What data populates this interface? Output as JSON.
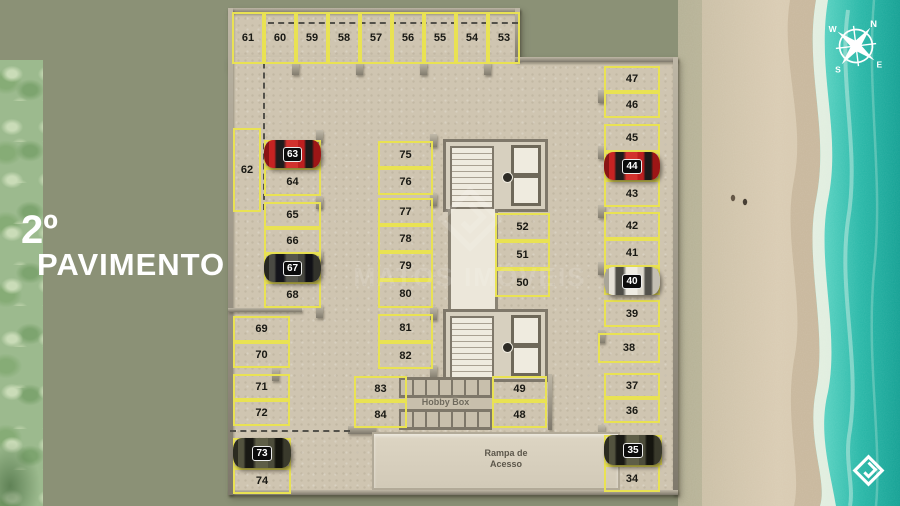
{
  "scene": {
    "title_line1": "2º",
    "title_line2": "PAVIMENTO",
    "watermark": "MATOS IMÓVEIS",
    "compass": {
      "n": "N",
      "e": "E",
      "s": "S",
      "w": "W"
    },
    "colors": {
      "background_sage": "#8b9176",
      "floor_concrete": "#cfc5b1",
      "stall_line_yellow": "#e9e253",
      "water_turquoise": "#1aab9c",
      "sand": "#d8cab1",
      "car_red": "#c62322",
      "car_dark": "#4a4a43",
      "car_white": "#e4e0d6",
      "car_olive": "#53533f"
    }
  },
  "floorplan": {
    "hobby_label": "Hobby Box",
    "ramp_label_line1": "Rampa de",
    "ramp_label_line2": "Acesso",
    "stalls": [
      {
        "n": "61",
        "x": 232,
        "y": 12,
        "w": 32,
        "h": 52,
        "car": null
      },
      {
        "n": "60",
        "x": 264,
        "y": 12,
        "w": 32,
        "h": 52,
        "car": null
      },
      {
        "n": "59",
        "x": 296,
        "y": 12,
        "w": 32,
        "h": 52,
        "car": null
      },
      {
        "n": "58",
        "x": 328,
        "y": 12,
        "w": 32,
        "h": 52,
        "car": null
      },
      {
        "n": "57",
        "x": 360,
        "y": 12,
        "w": 32,
        "h": 52,
        "car": null
      },
      {
        "n": "56",
        "x": 392,
        "y": 12,
        "w": 32,
        "h": 52,
        "car": null
      },
      {
        "n": "55",
        "x": 424,
        "y": 12,
        "w": 32,
        "h": 52,
        "car": null
      },
      {
        "n": "54",
        "x": 456,
        "y": 12,
        "w": 32,
        "h": 52,
        "car": null
      },
      {
        "n": "53",
        "x": 488,
        "y": 12,
        "w": 32,
        "h": 52,
        "car": null
      },
      {
        "n": "62",
        "x": 233,
        "y": 128,
        "w": 28,
        "h": 84,
        "car": null
      },
      {
        "n": "63",
        "x": 264,
        "y": 140,
        "w": 57,
        "h": 28,
        "car": "red"
      },
      {
        "n": "64",
        "x": 264,
        "y": 168,
        "w": 57,
        "h": 28,
        "car": null
      },
      {
        "n": "65",
        "x": 264,
        "y": 202,
        "w": 57,
        "h": 26,
        "car": null
      },
      {
        "n": "66",
        "x": 264,
        "y": 228,
        "w": 57,
        "h": 26,
        "car": null
      },
      {
        "n": "67",
        "x": 264,
        "y": 254,
        "w": 57,
        "h": 28,
        "car": "dark"
      },
      {
        "n": "68",
        "x": 264,
        "y": 282,
        "w": 57,
        "h": 26,
        "car": null
      },
      {
        "n": "69",
        "x": 233,
        "y": 316,
        "w": 57,
        "h": 26,
        "car": null
      },
      {
        "n": "70",
        "x": 233,
        "y": 342,
        "w": 57,
        "h": 26,
        "car": null
      },
      {
        "n": "71",
        "x": 233,
        "y": 374,
        "w": 57,
        "h": 26,
        "car": null
      },
      {
        "n": "72",
        "x": 233,
        "y": 400,
        "w": 57,
        "h": 26,
        "car": null
      },
      {
        "n": "73",
        "x": 233,
        "y": 438,
        "w": 58,
        "h": 30,
        "car": "olive"
      },
      {
        "n": "74",
        "x": 233,
        "y": 468,
        "w": 58,
        "h": 26,
        "car": null
      },
      {
        "n": "75",
        "x": 378,
        "y": 141,
        "w": 55,
        "h": 27,
        "car": null
      },
      {
        "n": "76",
        "x": 378,
        "y": 168,
        "w": 55,
        "h": 27,
        "car": null
      },
      {
        "n": "77",
        "x": 378,
        "y": 198,
        "w": 55,
        "h": 27,
        "car": null
      },
      {
        "n": "78",
        "x": 378,
        "y": 225,
        "w": 55,
        "h": 27,
        "car": null
      },
      {
        "n": "79",
        "x": 378,
        "y": 252,
        "w": 55,
        "h": 28,
        "car": null
      },
      {
        "n": "80",
        "x": 378,
        "y": 280,
        "w": 55,
        "h": 28,
        "car": null
      },
      {
        "n": "81",
        "x": 378,
        "y": 314,
        "w": 55,
        "h": 28,
        "car": null
      },
      {
        "n": "82",
        "x": 378,
        "y": 342,
        "w": 55,
        "h": 27,
        "car": null
      },
      {
        "n": "83",
        "x": 354,
        "y": 376,
        "w": 53,
        "h": 25,
        "car": null
      },
      {
        "n": "84",
        "x": 354,
        "y": 401,
        "w": 53,
        "h": 27,
        "car": null
      },
      {
        "n": "52",
        "x": 495,
        "y": 213,
        "w": 55,
        "h": 28,
        "car": null
      },
      {
        "n": "51",
        "x": 495,
        "y": 241,
        "w": 55,
        "h": 28,
        "car": null
      },
      {
        "n": "50",
        "x": 495,
        "y": 269,
        "w": 55,
        "h": 28,
        "car": null
      },
      {
        "n": "49",
        "x": 492,
        "y": 376,
        "w": 55,
        "h": 25,
        "car": null
      },
      {
        "n": "48",
        "x": 492,
        "y": 401,
        "w": 55,
        "h": 27,
        "car": null
      },
      {
        "n": "47",
        "x": 604,
        "y": 66,
        "w": 56,
        "h": 26,
        "car": null
      },
      {
        "n": "46",
        "x": 604,
        "y": 92,
        "w": 56,
        "h": 26,
        "car": null
      },
      {
        "n": "45",
        "x": 604,
        "y": 124,
        "w": 56,
        "h": 28,
        "car": null
      },
      {
        "n": "44",
        "x": 604,
        "y": 152,
        "w": 56,
        "h": 28,
        "car": "red"
      },
      {
        "n": "43",
        "x": 604,
        "y": 180,
        "w": 56,
        "h": 27,
        "car": null
      },
      {
        "n": "42",
        "x": 604,
        "y": 212,
        "w": 56,
        "h": 27,
        "car": null
      },
      {
        "n": "41",
        "x": 604,
        "y": 239,
        "w": 56,
        "h": 28,
        "car": null
      },
      {
        "n": "40",
        "x": 604,
        "y": 267,
        "w": 56,
        "h": 28,
        "car": "white"
      },
      {
        "n": "39",
        "x": 604,
        "y": 300,
        "w": 56,
        "h": 27,
        "car": null
      },
      {
        "n": "38",
        "x": 598,
        "y": 333,
        "w": 62,
        "h": 30,
        "car": null
      },
      {
        "n": "37",
        "x": 604,
        "y": 373,
        "w": 56,
        "h": 25,
        "car": null
      },
      {
        "n": "36",
        "x": 604,
        "y": 398,
        "w": 56,
        "h": 25,
        "car": null
      },
      {
        "n": "35",
        "x": 604,
        "y": 435,
        "w": 58,
        "h": 30,
        "car": "olive"
      },
      {
        "n": "34",
        "x": 604,
        "y": 465,
        "w": 56,
        "h": 27,
        "car": null
      }
    ]
  }
}
